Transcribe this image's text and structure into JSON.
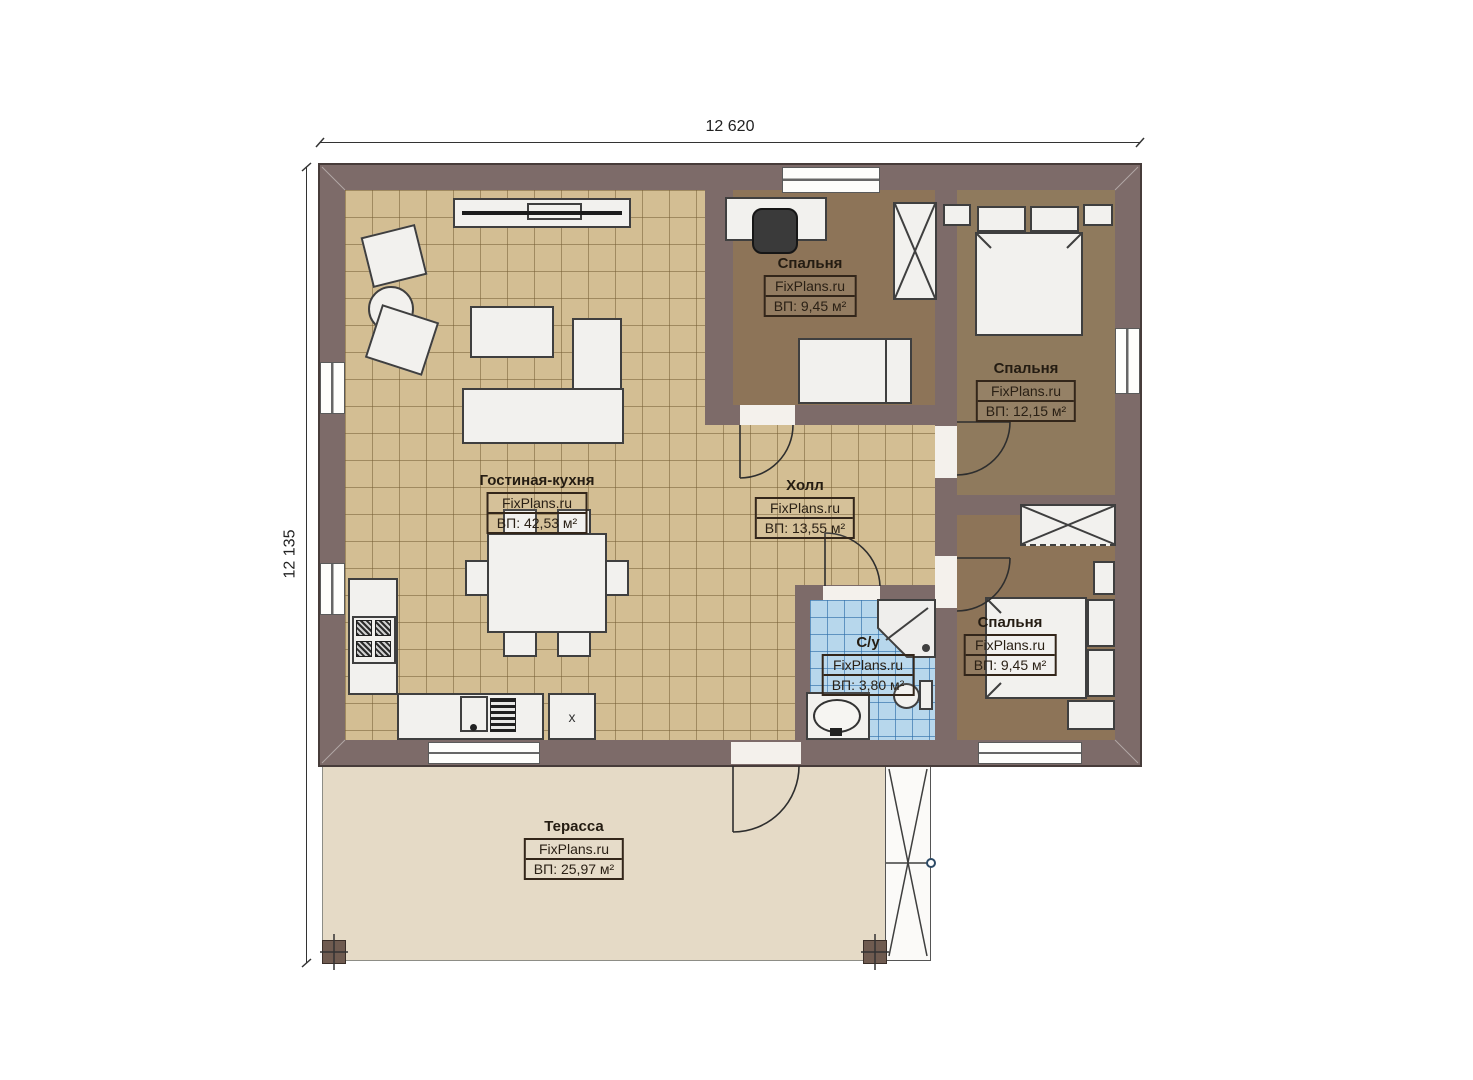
{
  "plan": {
    "dimensions": {
      "width_label": "12 620",
      "height_label": "12 135"
    },
    "watermark": "FixPlans.ru",
    "rooms": [
      {
        "key": "bedroom-top",
        "name": "Спальня",
        "area": "ВП: 9,45 м²"
      },
      {
        "key": "bedroom-right",
        "name": "Спальня",
        "area": "ВП: 12,15 м²"
      },
      {
        "key": "living-kitchen",
        "name": "Гостиная-кухня",
        "area": "ВП: 42,53 м²"
      },
      {
        "key": "hall",
        "name": "Холл",
        "area": "ВП: 13,55 м²"
      },
      {
        "key": "bathroom",
        "name": "С/у",
        "area": "ВП: 3,80 м²"
      },
      {
        "key": "bedroom-bottom",
        "name": "Спальня",
        "area": "ВП: 9,45 м²"
      },
      {
        "key": "terrace",
        "name": "Терасса",
        "area": "ВП: 25,97 м²"
      }
    ],
    "kitchen_cabinet_marker": "x",
    "colors": {
      "wall": "#7d6b69",
      "tile_floor": "#d3be93",
      "bedroom_floor": "#8d7458",
      "bathroom_floor": "#b7d7ec",
      "terrace_floor": "#e5dac6"
    }
  }
}
